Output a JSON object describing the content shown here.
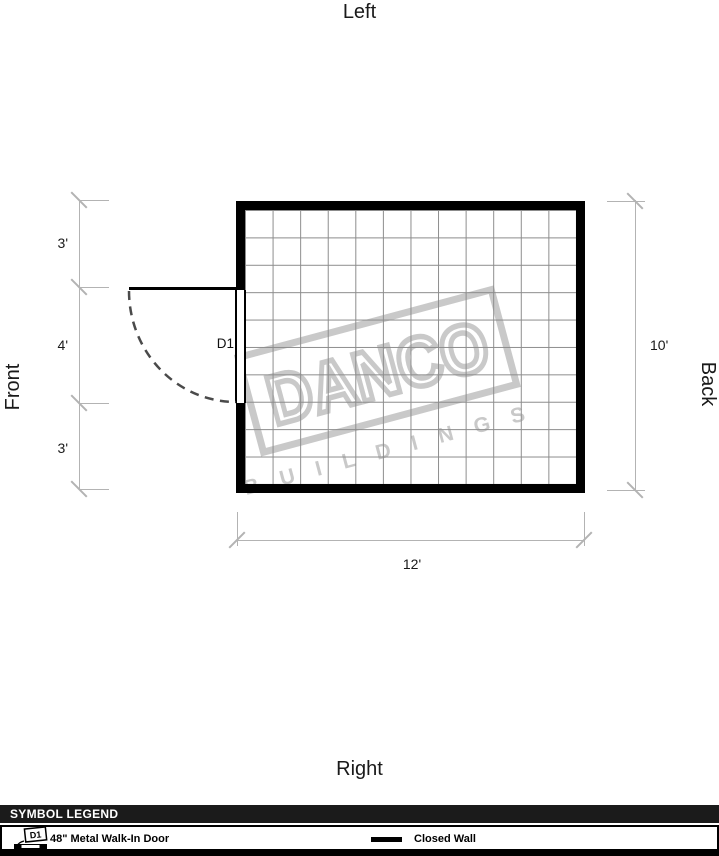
{
  "orientation": {
    "top": "Left",
    "bottom": "Right",
    "left_side": "Front",
    "right_side": "Back"
  },
  "plan": {
    "door": {
      "label": "D1"
    },
    "grid_cols": 12,
    "grid_rows": 10
  },
  "dimensions": {
    "left_segments": [
      "3'",
      "4'",
      "3'"
    ],
    "right_total": "10'",
    "bottom_total": "12'"
  },
  "watermark": {
    "line1": "DANCO",
    "line2": "BUILDINGS"
  },
  "legend": {
    "title": "SYMBOL LEGEND",
    "items": [
      {
        "symbol_label": "D1",
        "label": "48\" Metal Walk-In Door"
      },
      {
        "label": "Closed Wall"
      }
    ]
  },
  "colors": {
    "wall": "#000000",
    "grid_line": "#8c8c8c",
    "dimension_line": "#b3b3b3",
    "watermark": "#c9c9c9",
    "legend_header_bg": "#1b1b1b"
  }
}
